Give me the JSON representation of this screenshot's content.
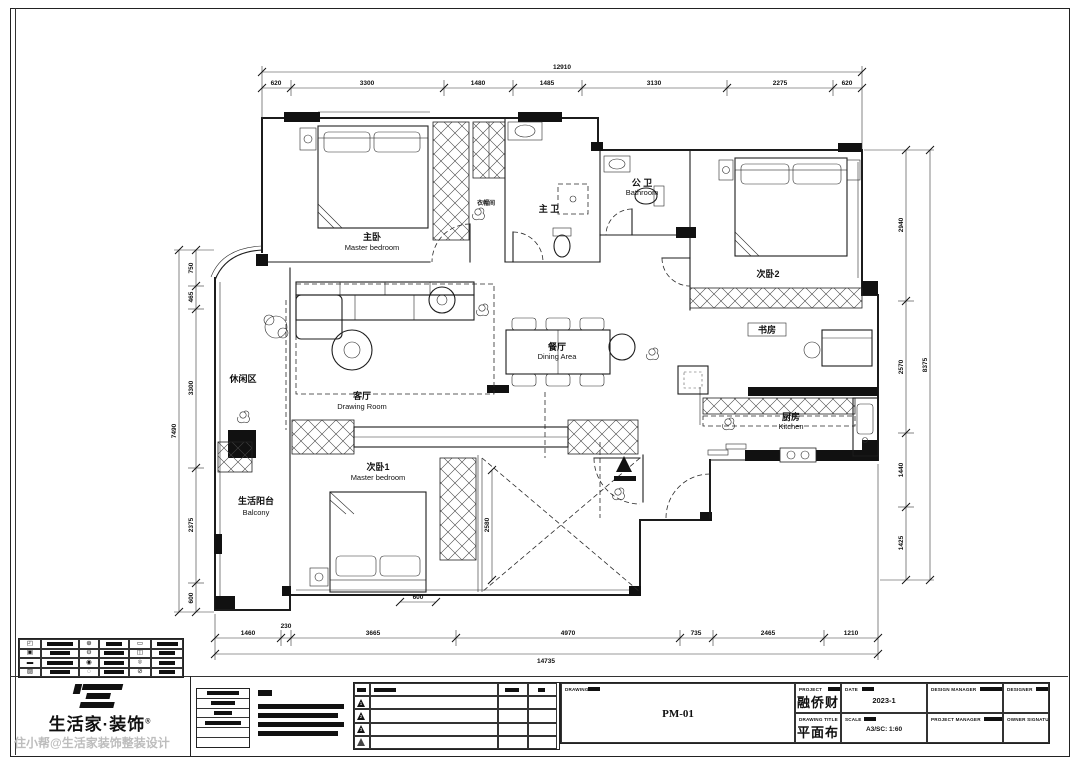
{
  "plan": {
    "rooms": {
      "master": {
        "zh": "主卧",
        "en": "Master bedroom"
      },
      "cloak": {
        "zh": "衣帽间"
      },
      "master_bath": {
        "zh": "主 卫"
      },
      "bath": {
        "zh": "公 卫",
        "en": "Bathroom"
      },
      "bedroom2": {
        "zh": "次卧2"
      },
      "study": {
        "zh": "书房"
      },
      "kitchen": {
        "zh": "厨房",
        "en": "Kitchen"
      },
      "dining": {
        "zh": "餐厅",
        "en": "Dining Area"
      },
      "living": {
        "zh": "客厅",
        "en": "Drawing Room"
      },
      "leisure": {
        "zh": "休闲区"
      },
      "bedroom1": {
        "zh": "次卧1",
        "en": "Master bedroom"
      },
      "balcony": {
        "zh": "生活阳台",
        "en": "Balcony"
      }
    },
    "dims": {
      "top": {
        "total": "12910",
        "segments": [
          "620",
          "3300",
          "1480",
          "1485",
          "3130",
          "2275",
          "620"
        ]
      },
      "bottom": {
        "total": "14735",
        "segments": [
          "1460",
          "230",
          "3665",
          "4970",
          "735",
          "2465",
          "1210"
        ]
      },
      "left": {
        "total": "7490",
        "segments": [
          "750",
          "465",
          "3300",
          "2375",
          "600"
        ]
      },
      "right": {
        "total": "8375",
        "segments": [
          "2940",
          "2570",
          "1440",
          "1425"
        ]
      },
      "inner_void": "2580",
      "inner_bed": "600"
    }
  },
  "legend": {
    "icons": [
      "◰",
      "⊕",
      "▭",
      "▣",
      "⊖",
      "◫",
      "▬",
      "◉",
      "⌾",
      "▨",
      "◌",
      "⊘"
    ]
  },
  "revision": {
    "marks": [
      "1",
      "2",
      "3",
      ""
    ]
  },
  "title_block": {
    "project_label": "PROJECT",
    "project_name": "融侨财徐壹号 A6#1302",
    "drawing_title_label": "DRAWING TITLE",
    "drawing_title": "平面布置图",
    "date_label": "DATE",
    "date_value": "2023-1",
    "scale_label": "SCALE",
    "scale_value": "A3/SC: 1:60",
    "design_manager_label": "DESIGN MANAGER",
    "project_manager_label": "PROJECT MANAGER",
    "designer_label": "DESIGNER",
    "owner_signature_label": "OWNER SIGNATURE",
    "drawing_label": "DRAWING",
    "drawing_number": "PM-01"
  },
  "branding": {
    "logo_name": "生活家·装饰",
    "logo_reg": "®",
    "watermark": "住小帮@生活家装饰整装设计"
  }
}
